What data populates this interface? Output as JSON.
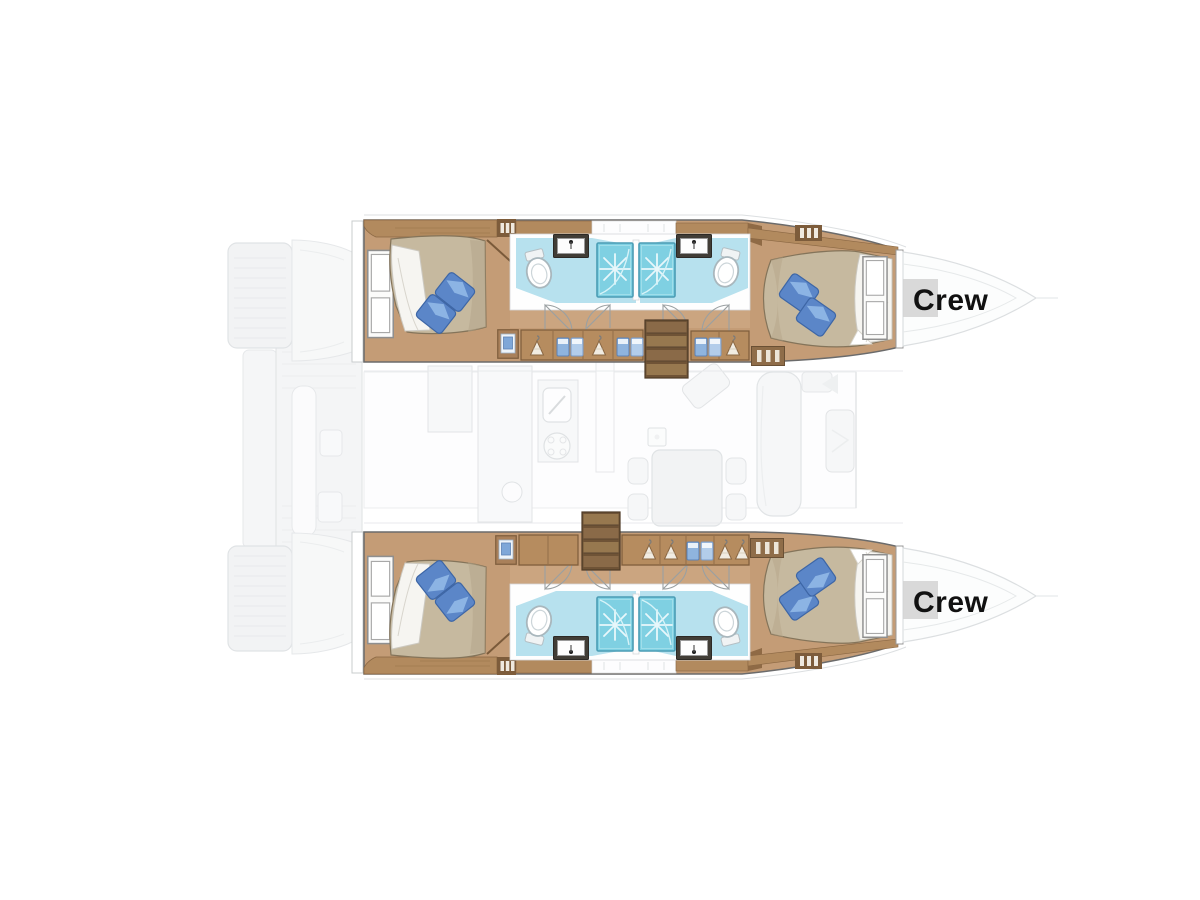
{
  "diagram_type": "catamaran-interior-layout-plan",
  "labels": {
    "crew_upper": "Crew",
    "crew_lower": "Crew"
  },
  "hulls": [
    {
      "id": "port-hull",
      "position": "top",
      "areas": [
        "aft-double-cabin",
        "ensuite-bathroom-aft",
        "ensuite-bathroom-forward",
        "twin-showers",
        "wardrobes",
        "companionway-stairs",
        "forward-double-cabin",
        "crew-bow-compartment"
      ]
    },
    {
      "id": "starboard-hull",
      "position": "bottom",
      "areas": [
        "aft-double-cabin",
        "ensuite-bathroom-aft",
        "ensuite-bathroom-forward",
        "twin-showers",
        "wardrobes",
        "companionway-stairs",
        "forward-double-cabin",
        "crew-bow-compartment"
      ]
    }
  ],
  "icons": [
    "double-bed",
    "pillow",
    "duvet",
    "hull-window",
    "toilet",
    "washbasin-sink",
    "shower-stall",
    "clothes-hanger",
    "folded-linen-shelf",
    "stairs",
    "drawer-dresser",
    "galley-sink",
    "stove-burner",
    "dining-table",
    "sofa",
    "mast-step"
  ],
  "colors": {
    "background": "#ffffff",
    "floor_wood": "#c49c76",
    "corridor_wood": "#cfa984",
    "cabinet_wood": "#b68c5f",
    "band_wood": "#b28a5e",
    "dark_wood": "#7d5c3b",
    "stairs_wood": "#6f5336",
    "mattress": "#c6b99f",
    "mattress_shade": "#b5a68a",
    "duvet": "#f6f5f1",
    "pillow_blue": "#5b86c8",
    "pillow_light": "#8fb6e6",
    "bath_floor": "#b7e1ee",
    "shower_blue": "#7fd0e2",
    "shower_border": "#4a9cb4",
    "ghost_fill": "#f2f3f4",
    "ghost_line": "#e1e4e6",
    "label_text": "#111111",
    "label_bg": "#d2d2d2"
  }
}
